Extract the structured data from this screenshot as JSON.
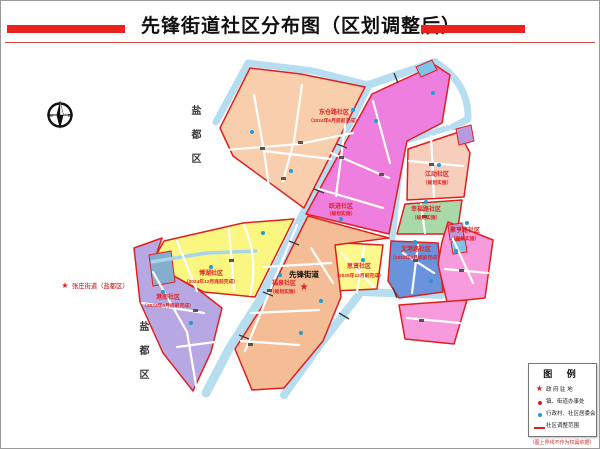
{
  "title": "先锋街道社区分布图（区划调整后）",
  "compass": {
    "west": "W",
    "east": "E"
  },
  "neighbor_district": {
    "upper": "盐都区",
    "lower": "盐都区"
  },
  "landmark": {
    "symbol": "★",
    "label": "张庄街道（盐都区）"
  },
  "street_seat": {
    "symbol": "★",
    "name": "先锋街道"
  },
  "regions": [
    {
      "name": "东仓路社区",
      "note": "（2024年6月底前完成）"
    },
    {
      "name": "跃进社区",
      "note": "（规划实施）"
    },
    {
      "name": "江动社区",
      "note": "（规划实施）"
    },
    {
      "name": "幸福路社区",
      "note": "（规划实施）"
    },
    {
      "name": "文港路社区",
      "note": "（2024年6月底前完成）"
    },
    {
      "name": "聚亨路社区",
      "note": "（规划实施）"
    },
    {
      "name": "思贤社区",
      "note": "（2025年12月前完成）"
    },
    {
      "name": "博湖社区",
      "note": "（2024年12月底前完成）"
    },
    {
      "name": "港南社区",
      "note": "（2024年6月底前完成）"
    },
    {
      "name": "福泉社区",
      "note": "（规划实施）"
    }
  ],
  "legend": {
    "title": "图 例",
    "items": [
      {
        "label": "政 府 驻 地"
      },
      {
        "label": "镇、街道办事处"
      },
      {
        "label": "行政村、社区居委会"
      },
      {
        "label": "社区调整范围"
      }
    ],
    "footnote": "（图上界线不作为权属依据）"
  },
  "colors": {
    "border_red": "#e02020",
    "river_blue": "#b7ddf1",
    "title_bar_red": "#e8231e",
    "marker_blue": "#1e9cd6"
  }
}
